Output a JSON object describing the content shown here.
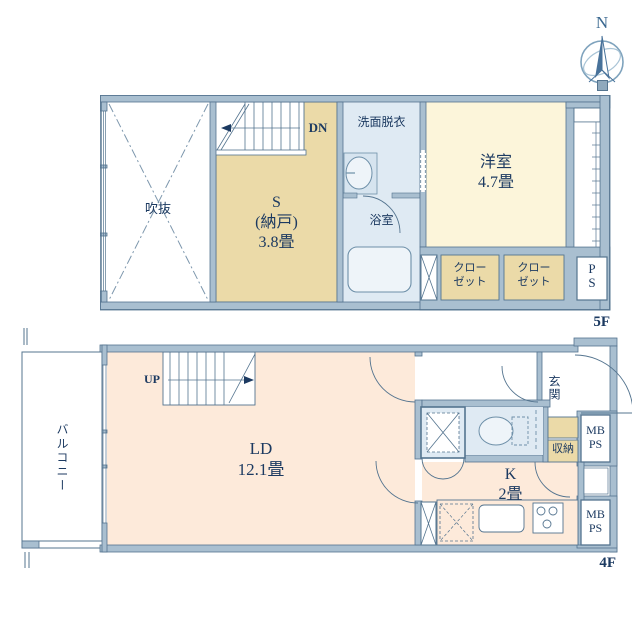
{
  "compass": {
    "north_label": "N"
  },
  "floor_5f": {
    "label": "5F",
    "void_label": "吹抜",
    "stairs_label": "DN",
    "storage_room": {
      "code": "S",
      "name": "(納戸)",
      "size": "3.8畳"
    },
    "washroom_label": "洗面脱衣",
    "bath_label": "浴室",
    "western_room": {
      "name": "洋室",
      "size": "4.7畳"
    },
    "closet_left": "クローゼット",
    "closet_right": "クローゼット",
    "pipe_space": "PS"
  },
  "floor_4f": {
    "label": "4F",
    "balcony_label": "バルコニー",
    "stairs_label": "UP",
    "living_dining": {
      "name": "LD",
      "size": "12.1畳"
    },
    "entrance_label": "玄関",
    "storage_label": "収納",
    "kitchen": {
      "name": "K",
      "size": "2畳"
    },
    "meter_box_upper": "MB PS",
    "meter_box_lower": "MB PS"
  },
  "colors": {
    "wall": "#a9bfd0",
    "line": "#54748f",
    "text": "#1c3a61",
    "tan": "#ebdaa8",
    "cream": "#fcf5da",
    "peach": "#fdeada",
    "water_blue": "#dfeaf3",
    "fixture": "#eef4f9",
    "compass_blue": "#48729a"
  }
}
